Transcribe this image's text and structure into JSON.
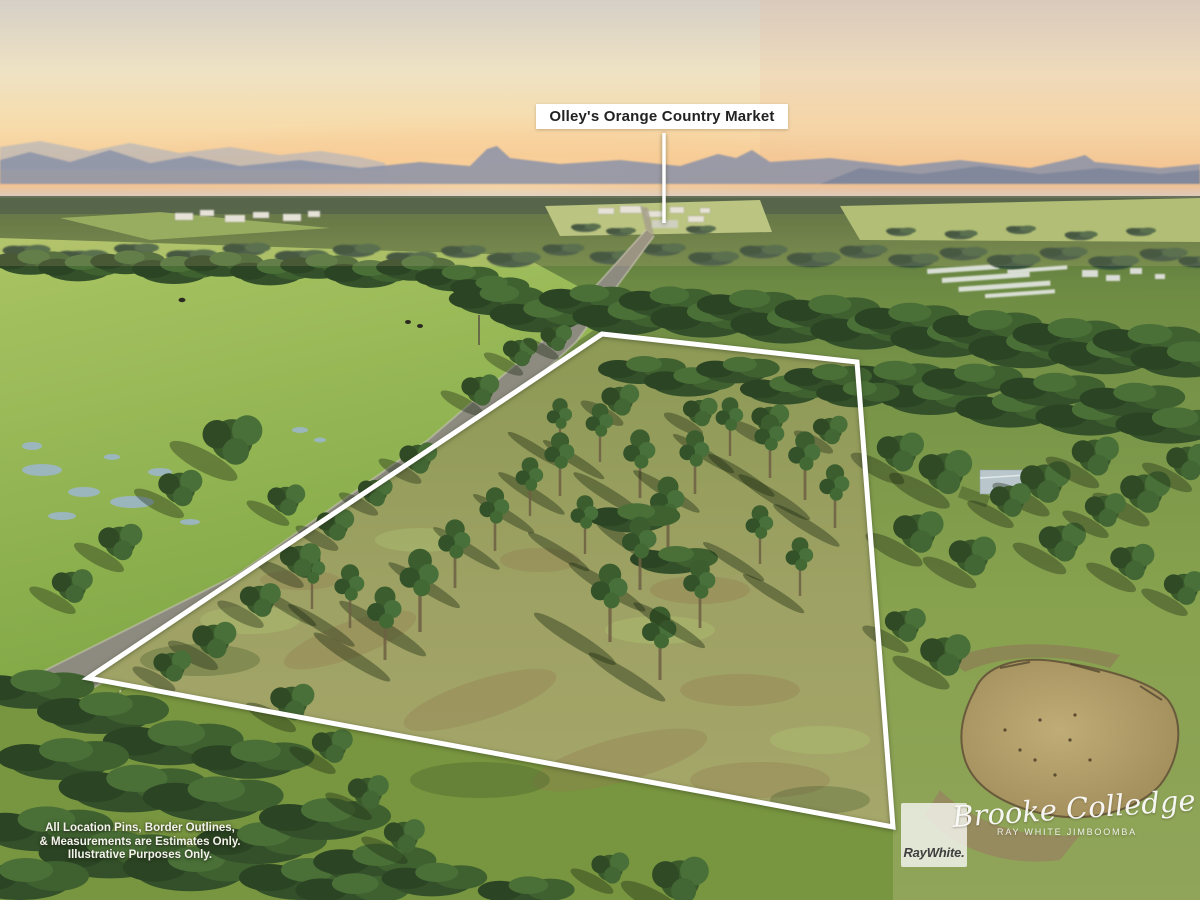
{
  "poi": {
    "label": "Olley's Orange Country Market"
  },
  "boundary": {
    "points": "602,334 857,362 893,827 88,678",
    "pointer_path": "M664,133 L664,223",
    "color": "#ffffff"
  },
  "disclaimer": {
    "line1": "All Location Pins, Border Outlines,",
    "line2": "& Measurements are Estimates Only.",
    "line3": "Illustrative Purposes Only."
  },
  "credits": {
    "logo": "RayWhite.",
    "signature": "Brooke Colledge",
    "agency": "RAY WHITE JIMBOOMBA"
  }
}
